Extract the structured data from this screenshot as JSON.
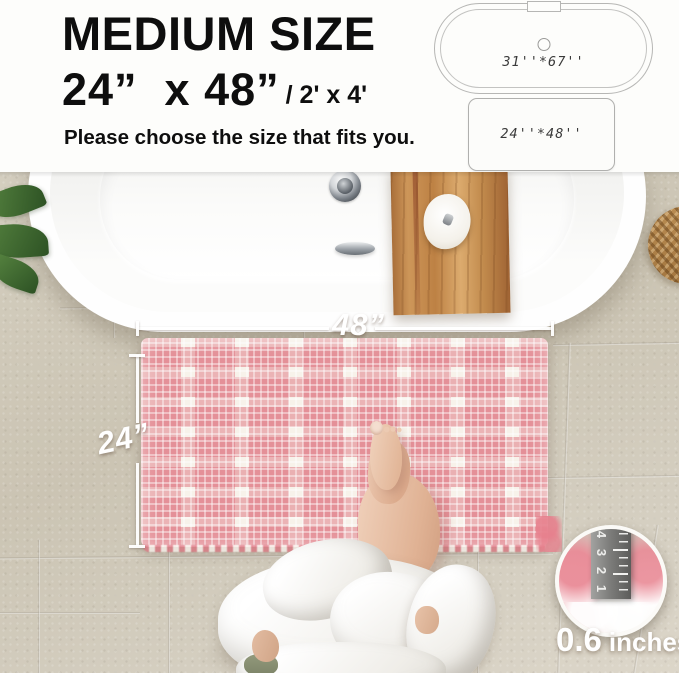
{
  "header": {
    "title": "MEDIUM SIZE",
    "size_primary": "24”  x 48”",
    "size_secondary": "/ 2' x 4'",
    "subtitle": "Please choose the size that fits you."
  },
  "size_diagrams": {
    "bathtub_outline_label": "31''*67''",
    "mat_outline_label": "24''*48''"
  },
  "scene": {
    "width_dimension_label": "48”",
    "height_dimension_label": "24”",
    "pile_detail": {
      "value": "0.6",
      "unit": "inches",
      "ruler_numbers": [
        "1",
        "2",
        "3",
        "4"
      ]
    }
  },
  "colors": {
    "header_background": "#fdfdfb",
    "headline_text": "#0e0e0e",
    "annotation_white": "#ffffff",
    "mat_pink": "#de6e7b",
    "mat_base": "#f7f2ea",
    "floor_beige": "#cfc8b8",
    "wood_brown": "#bd8144",
    "leaf_green": "#3f6b35",
    "diagram_line_gray": "#b6b6b4"
  }
}
